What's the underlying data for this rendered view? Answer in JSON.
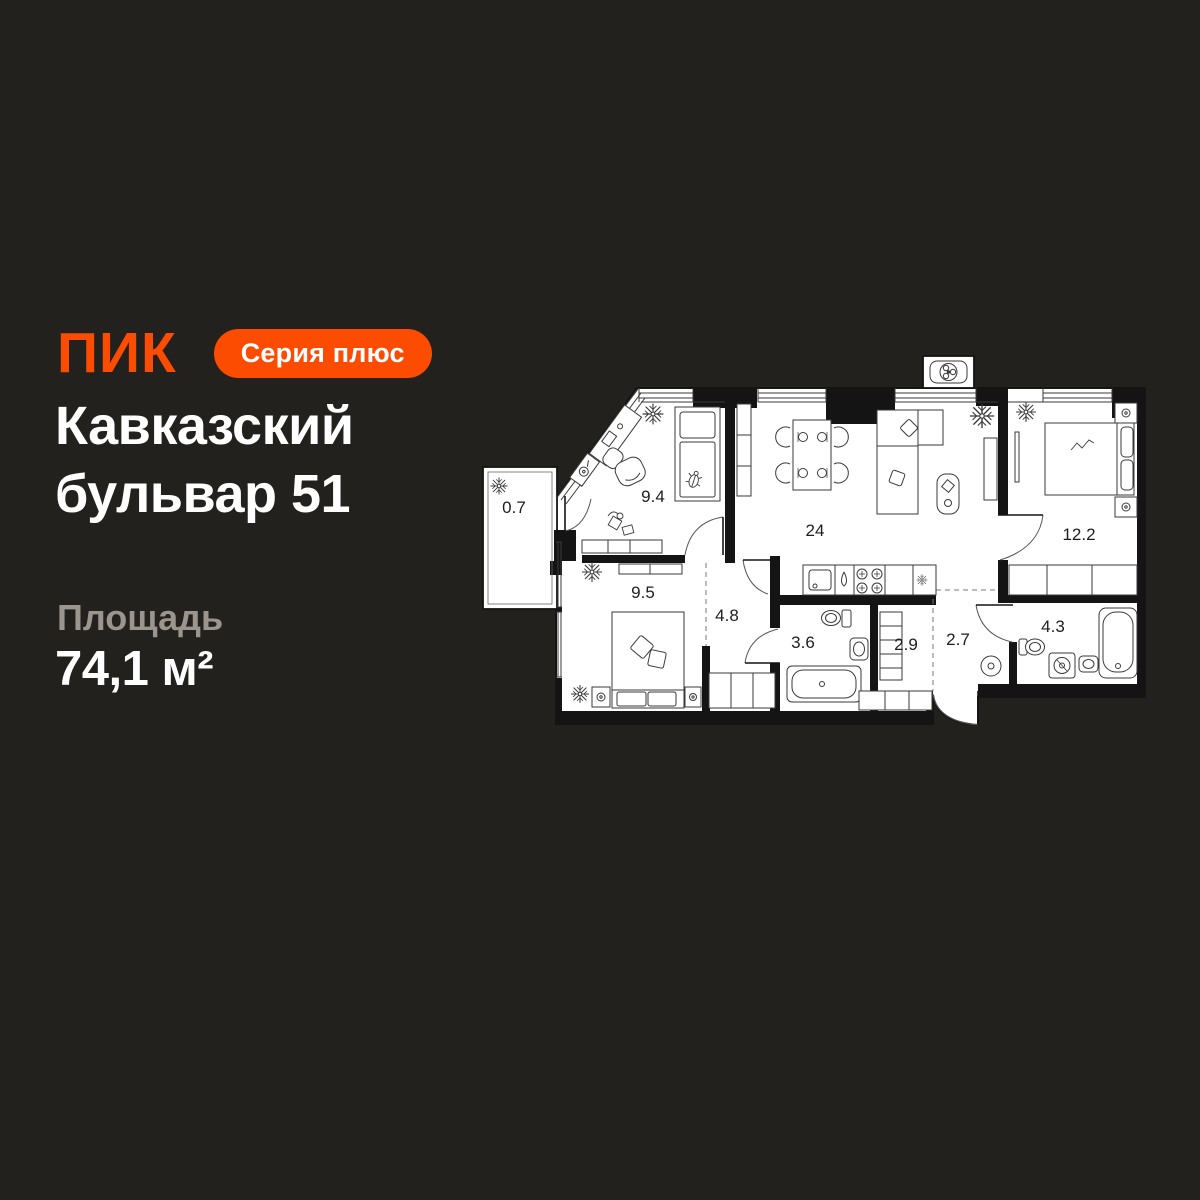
{
  "brand": {
    "logo": "ПИК",
    "badge": "Серия плюс"
  },
  "listing": {
    "title": "Кавказский бульвар 51",
    "area_label": "Площадь",
    "area_value": "74,1 м²"
  },
  "colors": {
    "background": "#23211E",
    "accent_orange": "#FC4C02",
    "text_primary": "#FFFFFF",
    "text_secondary": "#9C958D",
    "plan_floor": "#FFFFFF",
    "plan_walls": "#141414"
  },
  "plan": {
    "rooms": [
      {
        "label": "0.7",
        "x": 33,
        "y": 163
      },
      {
        "label": "9.4",
        "x": 172,
        "y": 152
      },
      {
        "label": "24",
        "x": 334,
        "y": 186
      },
      {
        "label": "12.2",
        "x": 598,
        "y": 190
      },
      {
        "label": "9.5",
        "x": 162,
        "y": 248
      },
      {
        "label": "4.8",
        "x": 246,
        "y": 271
      },
      {
        "label": "3.6",
        "x": 322,
        "y": 298
      },
      {
        "label": "2.9",
        "x": 425,
        "y": 300
      },
      {
        "label": "2.7",
        "x": 477,
        "y": 295
      },
      {
        "label": "4.3",
        "x": 572,
        "y": 282
      }
    ]
  }
}
